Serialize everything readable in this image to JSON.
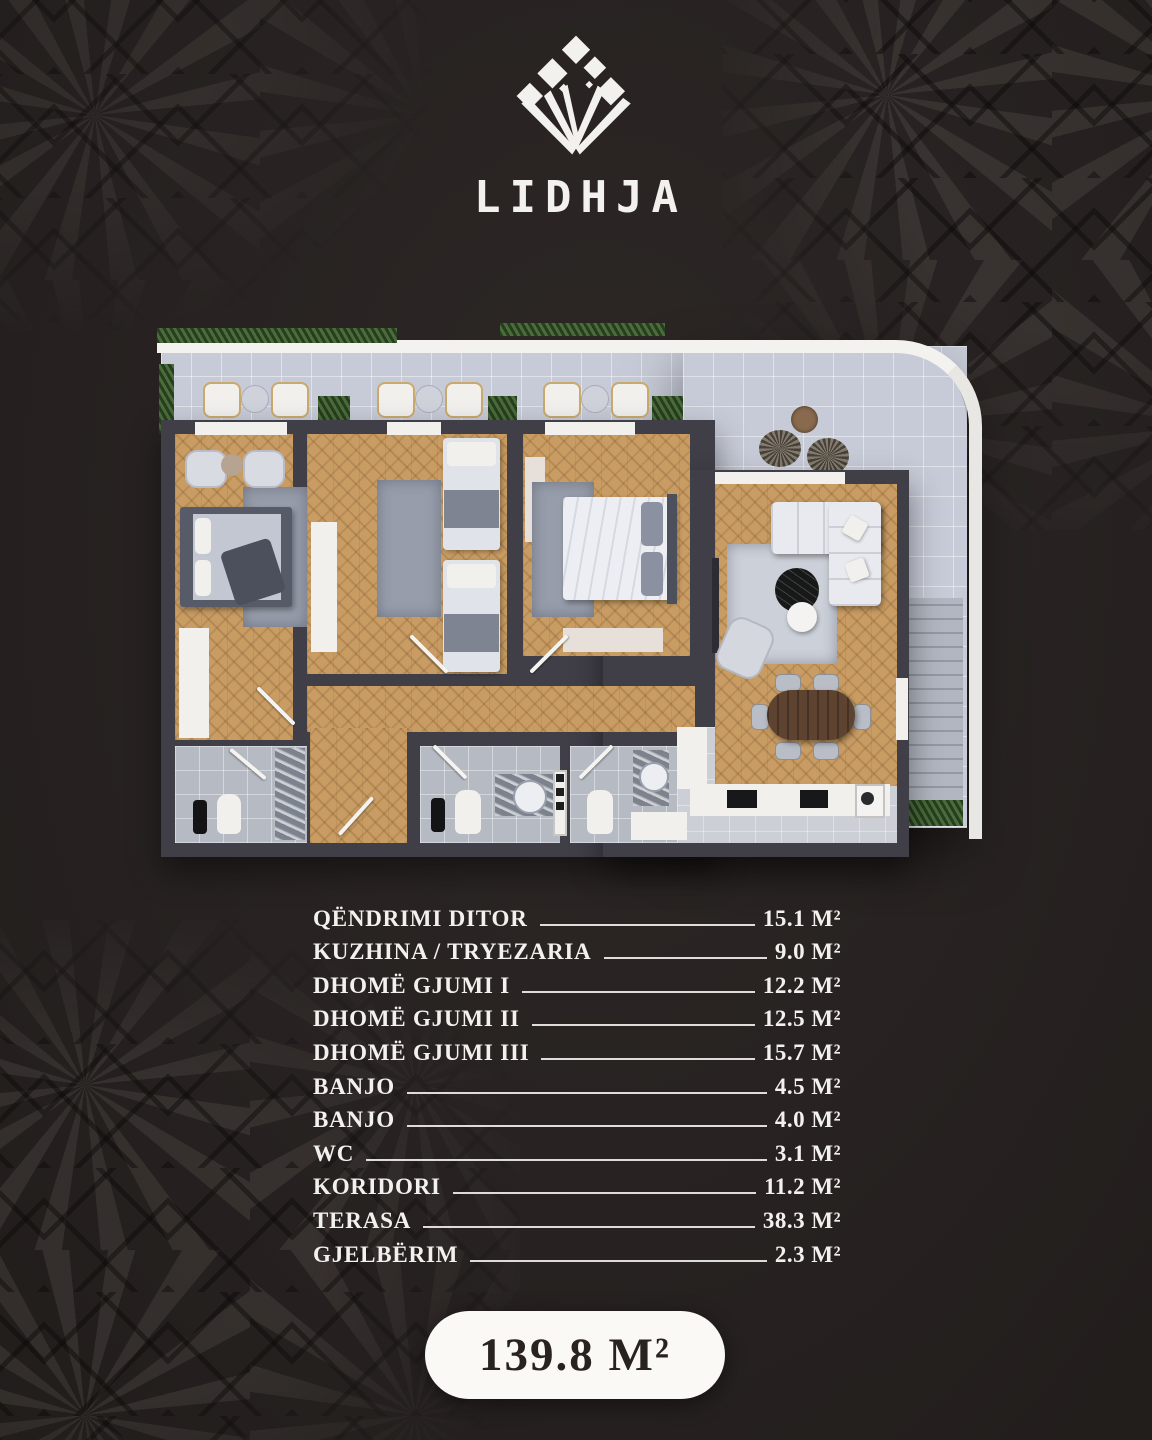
{
  "brand": {
    "name": "LIDHJA"
  },
  "floor_plan": {
    "description": "3D top-down render of an apartment with wrap-around terrace, three bedrooms, living room, kitchen/dining, two bathrooms, WC, corridor and greenery"
  },
  "room_list": {
    "rows": [
      {
        "label": "QËNDRIMI DITOR",
        "area": "15.1 M²"
      },
      {
        "label": "KUZHINA / TRYEZARIA",
        "area": "9.0 M²"
      },
      {
        "label": "DHOMË GJUMI I",
        "area": "12.2 M²"
      },
      {
        "label": "DHOMË GJUMI II",
        "area": "12.5 M²"
      },
      {
        "label": "DHOMË GJUMI III",
        "area": "15.7 M²"
      },
      {
        "label": "BANJO",
        "area": "4.5 M²"
      },
      {
        "label": "BANJO",
        "area": "4.0 M²"
      },
      {
        "label": "WC",
        "area": "3.1 M²"
      },
      {
        "label": "KORIDORI",
        "area": "11.2 M²"
      },
      {
        "label": "TERASA",
        "area": "38.3 M²"
      },
      {
        "label": "GJELBËRIM",
        "area": "2.3 M²"
      }
    ]
  },
  "total": {
    "area": "139.8 M²"
  },
  "colors": {
    "background": "#272221",
    "pattern": "#4a443f",
    "text": "#f3f1ed",
    "badge_background": "#fbf9f6",
    "badge_text": "#282220",
    "wood_floor": "#c89c63",
    "walls": "#403e47",
    "terrace_tile": "#c7cbd7",
    "greenery": "#3c5a31"
  }
}
